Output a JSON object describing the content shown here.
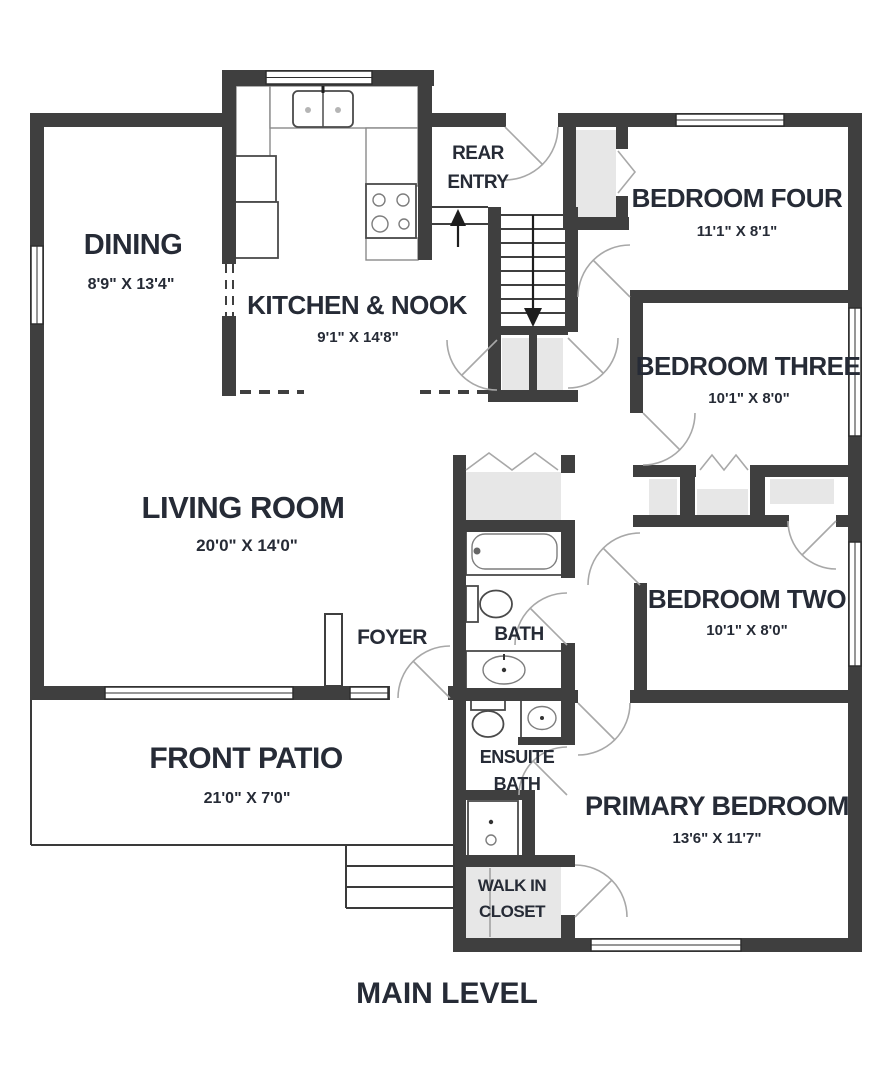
{
  "plan": {
    "title": "MAIN LEVEL",
    "rooms": {
      "dining": {
        "name": "DINING",
        "dims": "8'9\" X 13'4\""
      },
      "kitchen_nook": {
        "name": "KITCHEN & NOOK",
        "dims": "9'1\" X 14'8\""
      },
      "rear_entry": {
        "name_line1": "REAR",
        "name_line2": "ENTRY"
      },
      "bedroom_four": {
        "name": "BEDROOM FOUR",
        "dims": "11'1\" X 8'1\""
      },
      "bedroom_three": {
        "name": "BEDROOM THREE",
        "dims": "10'1\" X 8'0\""
      },
      "living_room": {
        "name": "LIVING ROOM",
        "dims": "20'0\" X 14'0\""
      },
      "foyer": {
        "name": "FOYER"
      },
      "bath": {
        "name": "BATH"
      },
      "bedroom_two": {
        "name": "BEDROOM TWO",
        "dims": "10'1\" X 8'0\""
      },
      "front_patio": {
        "name": "FRONT PATIO",
        "dims": "21'0\" X 7'0\""
      },
      "ensuite_bath": {
        "name_line1": "ENSUITE",
        "name_line2": "BATH"
      },
      "primary_bedroom": {
        "name": "PRIMARY BEDROOM",
        "dims": "13'6\" X 11'7\""
      },
      "walk_in_closet": {
        "name_line1": "WALK IN",
        "name_line2": "CLOSET"
      }
    },
    "colors": {
      "wall": "#3f3f3f",
      "text": "#262b36",
      "closet_fill": "#e7e7e7",
      "background": "#ffffff"
    }
  }
}
